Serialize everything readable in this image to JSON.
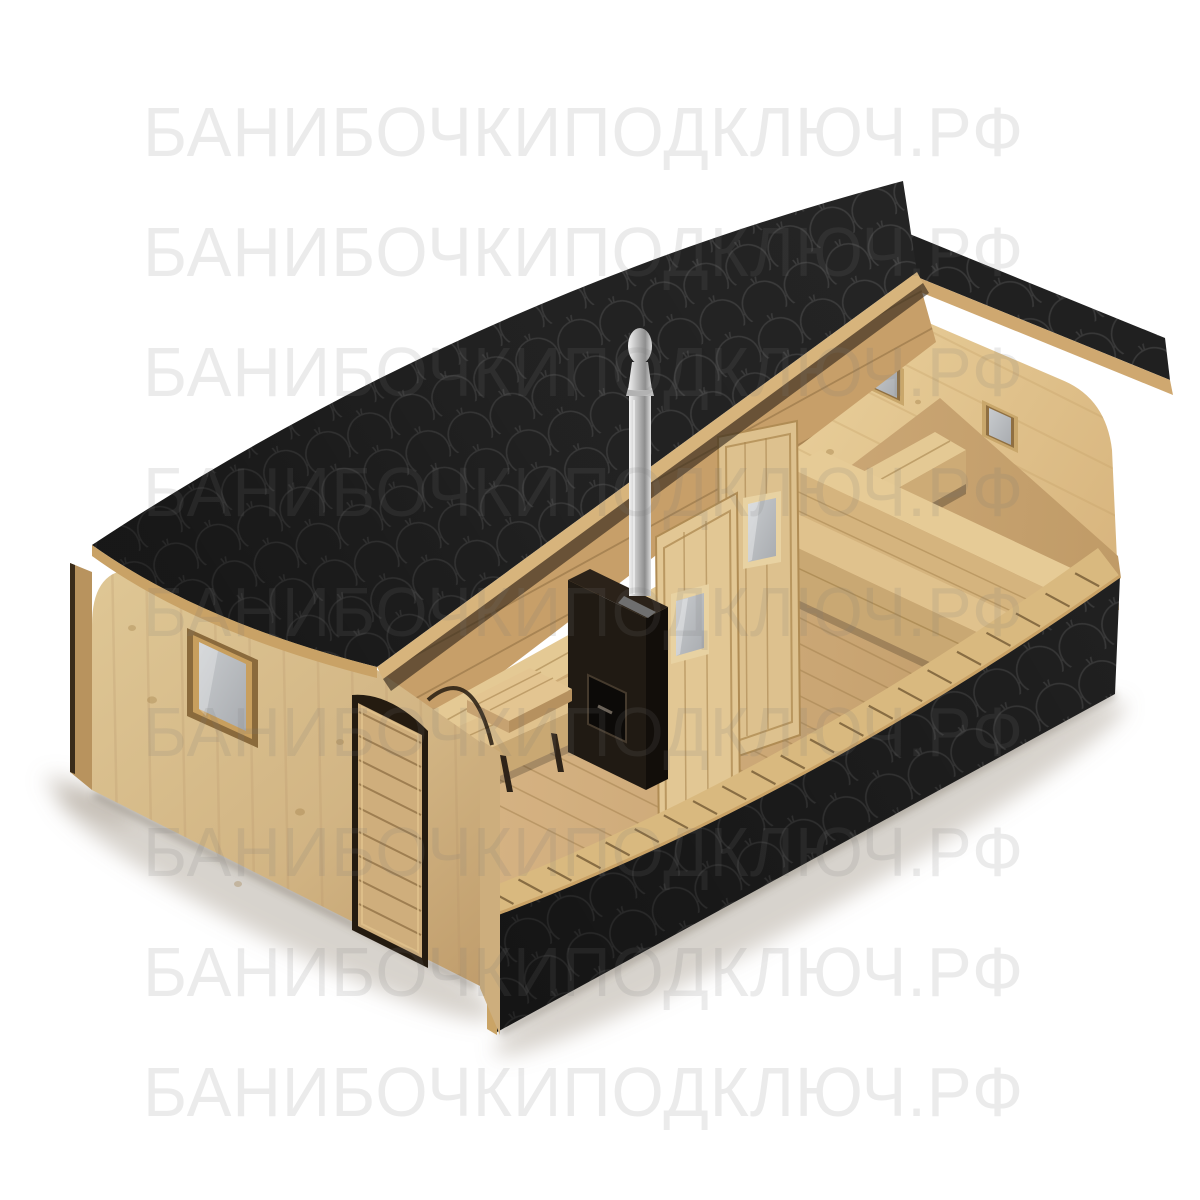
{
  "image": {
    "kind": "3d-product-render",
    "subject": "quadro-barrel-sauna-cutaway",
    "background": "#ffffff"
  },
  "watermark": {
    "text": "БАНИБОЧКИПОДКЛЮЧ.РФ",
    "rows": 9,
    "first_row_top_px": 97,
    "row_spacing_px": 120,
    "left_px": 143,
    "font_size_px": 70,
    "color": "rgba(118,118,118,0.15)"
  },
  "palette": {
    "roof_shingle_black": "#232323",
    "shingle_arc": "#3c3c3c",
    "skirt_black": "#1e1e1e",
    "wood_wall_light": "#dfc697",
    "wood_wall_shadow": "#c2a06d",
    "wood_interior": "#ead2a0",
    "wood_floor": "#d9b787",
    "wood_rim_tan": "#c9a266",
    "wood_dark_line": "#8a6a3f",
    "glass_gray": "#bfc3c6",
    "chimney_silver": "#d9d9d9",
    "stove_black": "#1d1711",
    "shadow": "rgba(120,110,95,0.38)"
  }
}
